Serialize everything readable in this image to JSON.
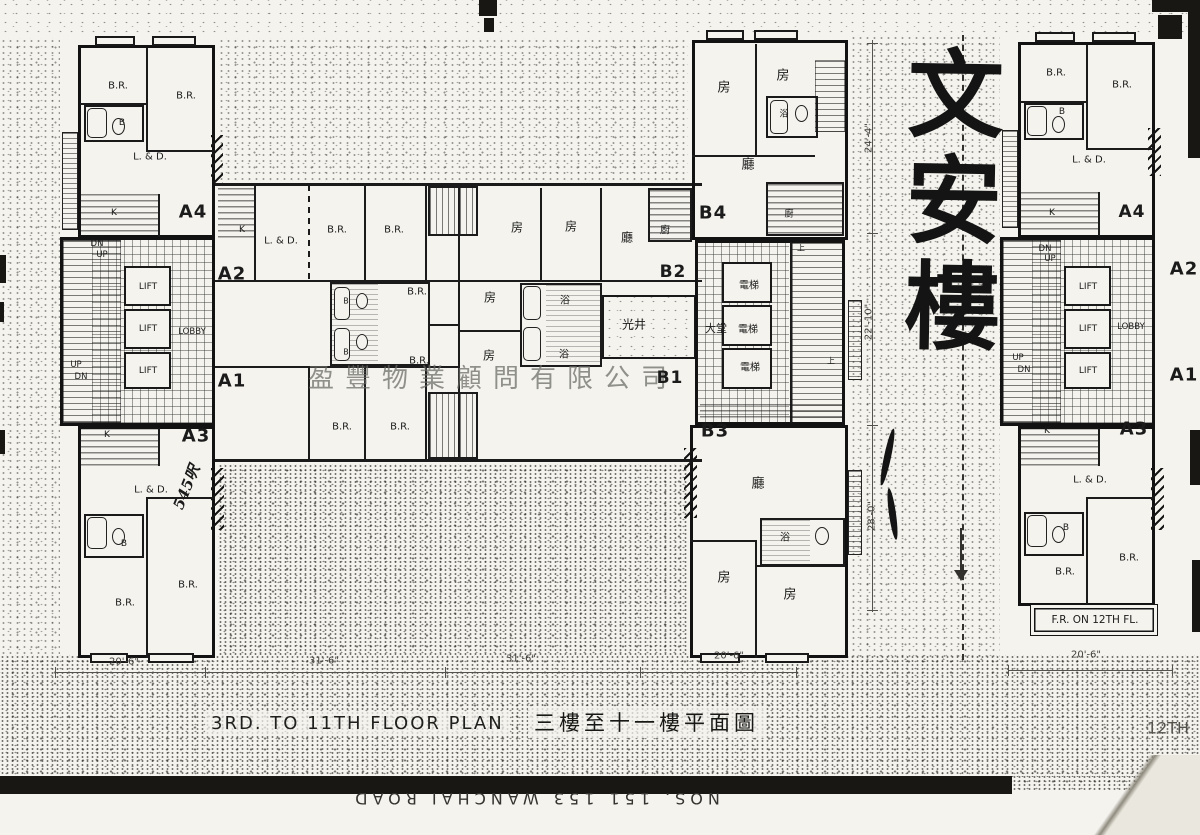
{
  "page": {
    "title_en": "3RD. TO 11TH FLOOR PLAN",
    "title_zh": "三樓至十一樓平面圖",
    "building_name": "文安樓",
    "watermark": "盈豐物業顧問有限公司",
    "street_text": "NOS. 151  153  WANCHAI  ROAD"
  },
  "colors": {
    "ink": "#1b1b1b",
    "paper": "#f4f3ee",
    "watermark": "#69695f"
  },
  "labels": [
    {
      "id": "a4-br1",
      "text": "B.R.",
      "x": 118,
      "y": 86,
      "s": 10
    },
    {
      "id": "a4-br2",
      "text": "B.R.",
      "x": 186,
      "y": 96,
      "s": 10
    },
    {
      "id": "a4-b",
      "text": "B",
      "x": 122,
      "y": 123,
      "s": 9
    },
    {
      "id": "a4-ld",
      "text": "L. & D.",
      "x": 150,
      "y": 157,
      "s": 10
    },
    {
      "id": "a4-k",
      "text": "K",
      "x": 114,
      "y": 213,
      "s": 9
    },
    {
      "id": "unit-a4",
      "text": "A4",
      "x": 193,
      "y": 212,
      "s": 18,
      "b": 1
    },
    {
      "id": "a4-dn",
      "text": "DN",
      "x": 97,
      "y": 244,
      "s": 8.5
    },
    {
      "id": "a4-up",
      "text": "UP",
      "x": 102,
      "y": 255,
      "s": 8.5
    },
    {
      "id": "lift-1",
      "text": "LIFT",
      "x": 148,
      "y": 287,
      "s": 9
    },
    {
      "id": "lift-2",
      "text": "LIFT",
      "x": 148,
      "y": 329,
      "s": 9
    },
    {
      "id": "lift-3",
      "text": "LIFT",
      "x": 148,
      "y": 371,
      "s": 9
    },
    {
      "id": "lobby",
      "text": "LOBBY",
      "x": 192,
      "y": 332,
      "s": 8.5
    },
    {
      "id": "core-up",
      "text": "UP",
      "x": 76,
      "y": 365,
      "s": 8.5
    },
    {
      "id": "core-dn",
      "text": "DN",
      "x": 81,
      "y": 377,
      "s": 8.5
    },
    {
      "id": "unit-a2",
      "text": "A2",
      "x": 232,
      "y": 274,
      "s": 18,
      "b": 1
    },
    {
      "id": "unit-a1",
      "text": "A1",
      "x": 232,
      "y": 381,
      "s": 18,
      "b": 1
    },
    {
      "id": "unit-a3",
      "text": "A3",
      "x": 196,
      "y": 436,
      "s": 18,
      "b": 1
    },
    {
      "id": "a3-k",
      "text": "K",
      "x": 107,
      "y": 435,
      "s": 9
    },
    {
      "id": "a3-ld",
      "text": "L. & D.",
      "x": 151,
      "y": 490,
      "s": 10
    },
    {
      "id": "a3-b",
      "text": "B",
      "x": 124,
      "y": 544,
      "s": 9
    },
    {
      "id": "a3-br1",
      "text": "B.R.",
      "x": 188,
      "y": 585,
      "s": 10
    },
    {
      "id": "a3-br2",
      "text": "B.R.",
      "x": 125,
      "y": 603,
      "s": 10
    },
    {
      "id": "note-545",
      "text": "545呎",
      "x": 186,
      "y": 487,
      "s": 15,
      "rot": -68,
      "cls": "hand"
    },
    {
      "id": "a2-k",
      "text": "K",
      "x": 242,
      "y": 230,
      "s": 9
    },
    {
      "id": "a2-ld",
      "text": "L. & D.",
      "x": 281,
      "y": 241,
      "s": 10
    },
    {
      "id": "a2-br1",
      "text": "B.R.",
      "x": 337,
      "y": 230,
      "s": 10
    },
    {
      "id": "a2-br2",
      "text": "B.R.",
      "x": 394,
      "y": 230,
      "s": 10
    },
    {
      "id": "mid-br1",
      "text": "B.R.",
      "x": 417,
      "y": 292,
      "s": 10
    },
    {
      "id": "mid-b1",
      "text": "B",
      "x": 346,
      "y": 301,
      "s": 8
    },
    {
      "id": "mid-b2",
      "text": "B",
      "x": 346,
      "y": 352,
      "s": 8
    },
    {
      "id": "mid-br2",
      "text": "B.R.",
      "x": 419,
      "y": 361,
      "s": 10
    },
    {
      "id": "a1-br1",
      "text": "B.R.",
      "x": 342,
      "y": 427,
      "s": 10
    },
    {
      "id": "a1-br2",
      "text": "B.R.",
      "x": 400,
      "y": 427,
      "s": 10
    },
    {
      "id": "b2-r1",
      "text": "房",
      "x": 517,
      "y": 227,
      "s": 12,
      "cls": "cjk"
    },
    {
      "id": "b2-r2",
      "text": "房",
      "x": 571,
      "y": 226,
      "s": 12,
      "cls": "cjk"
    },
    {
      "id": "b2-liv",
      "text": "廳",
      "x": 627,
      "y": 237,
      "s": 12,
      "cls": "cjk"
    },
    {
      "id": "b2-kit",
      "text": "廚",
      "x": 665,
      "y": 229,
      "s": 10,
      "cls": "cjk"
    },
    {
      "id": "unit-b2",
      "text": "B2",
      "x": 673,
      "y": 272,
      "s": 17,
      "b": 1
    },
    {
      "id": "b1-r1",
      "text": "房",
      "x": 490,
      "y": 297,
      "s": 12,
      "cls": "cjk"
    },
    {
      "id": "b1-bath1",
      "text": "浴",
      "x": 565,
      "y": 299,
      "s": 10,
      "cls": "cjk"
    },
    {
      "id": "lightwell",
      "text": "光井",
      "x": 634,
      "y": 324,
      "s": 12,
      "cls": "cjk"
    },
    {
      "id": "b1-bath2",
      "text": "浴",
      "x": 564,
      "y": 353,
      "s": 10,
      "cls": "cjk"
    },
    {
      "id": "b1-r2",
      "text": "房",
      "x": 489,
      "y": 355,
      "s": 12,
      "cls": "cjk"
    },
    {
      "id": "unit-b1",
      "text": "B1",
      "x": 670,
      "y": 378,
      "s": 17,
      "b": 1
    },
    {
      "id": "b4-r1",
      "text": "房",
      "x": 724,
      "y": 86,
      "s": 13,
      "cls": "cjk"
    },
    {
      "id": "b4-r2",
      "text": "房",
      "x": 783,
      "y": 74,
      "s": 13,
      "cls": "cjk"
    },
    {
      "id": "b4-bath",
      "text": "浴",
      "x": 784,
      "y": 113,
      "s": 9,
      "cls": "cjk"
    },
    {
      "id": "b4-liv",
      "text": "廳",
      "x": 748,
      "y": 163,
      "s": 13,
      "cls": "cjk"
    },
    {
      "id": "unit-b4",
      "text": "B4",
      "x": 713,
      "y": 213,
      "s": 18,
      "b": 1
    },
    {
      "id": "b4-kit",
      "text": "廚",
      "x": 789,
      "y": 213,
      "s": 9,
      "cls": "cjk"
    },
    {
      "id": "elev-1",
      "text": "電梯",
      "x": 749,
      "y": 284,
      "s": 10,
      "cls": "cjk"
    },
    {
      "id": "elev-2",
      "text": "電梯",
      "x": 748,
      "y": 328,
      "s": 10,
      "cls": "cjk"
    },
    {
      "id": "elev-3",
      "text": "電梯",
      "x": 750,
      "y": 366,
      "s": 10,
      "cls": "cjk"
    },
    {
      "id": "hall",
      "text": "大堂",
      "x": 716,
      "y": 328,
      "s": 11,
      "cls": "cjk"
    },
    {
      "id": "stair-up1",
      "text": "上",
      "x": 801,
      "y": 248,
      "s": 8,
      "cls": "cjk"
    },
    {
      "id": "stair-up2",
      "text": "上",
      "x": 831,
      "y": 361,
      "s": 8,
      "cls": "cjk"
    },
    {
      "id": "unit-b3",
      "text": "B3",
      "x": 715,
      "y": 431,
      "s": 18,
      "b": 1
    },
    {
      "id": "b3-liv",
      "text": "廳",
      "x": 758,
      "y": 482,
      "s": 13,
      "cls": "cjk"
    },
    {
      "id": "b3-bath",
      "text": "浴",
      "x": 785,
      "y": 536,
      "s": 10,
      "cls": "cjk"
    },
    {
      "id": "b3-r1",
      "text": "房",
      "x": 724,
      "y": 576,
      "s": 13,
      "cls": "cjk"
    },
    {
      "id": "b3-r2",
      "text": "房",
      "x": 790,
      "y": 593,
      "s": 13,
      "cls": "cjk"
    },
    {
      "id": "rp-br1",
      "text": "B.R.",
      "x": 1056,
      "y": 73,
      "s": 10
    },
    {
      "id": "rp-br2",
      "text": "B.R.",
      "x": 1122,
      "y": 85,
      "s": 10
    },
    {
      "id": "rp-b1",
      "text": "B",
      "x": 1062,
      "y": 112,
      "s": 9
    },
    {
      "id": "rp-ld1",
      "text": "L. & D.",
      "x": 1089,
      "y": 160,
      "s": 10
    },
    {
      "id": "rp-k1",
      "text": "K",
      "x": 1052,
      "y": 213,
      "s": 9
    },
    {
      "id": "rp-a4",
      "text": "A4",
      "x": 1132,
      "y": 212,
      "s": 17,
      "b": 1
    },
    {
      "id": "rp-dn1",
      "text": "DN",
      "x": 1045,
      "y": 249,
      "s": 8.5
    },
    {
      "id": "rp-up1",
      "text": "UP",
      "x": 1050,
      "y": 259,
      "s": 8.5
    },
    {
      "id": "rp-lift1",
      "text": "LIFT",
      "x": 1088,
      "y": 287,
      "s": 9
    },
    {
      "id": "rp-lift2",
      "text": "LIFT",
      "x": 1088,
      "y": 329,
      "s": 9
    },
    {
      "id": "rp-lift3",
      "text": "LIFT",
      "x": 1088,
      "y": 371,
      "s": 9
    },
    {
      "id": "rp-lobby",
      "text": "LOBBY",
      "x": 1131,
      "y": 327,
      "s": 8.5
    },
    {
      "id": "rp-up2",
      "text": "UP",
      "x": 1018,
      "y": 358,
      "s": 8.5
    },
    {
      "id": "rp-dn2",
      "text": "DN",
      "x": 1024,
      "y": 370,
      "s": 8.5
    },
    {
      "id": "rp-a2",
      "text": "A2",
      "x": 1184,
      "y": 269,
      "s": 18,
      "b": 1
    },
    {
      "id": "rp-a1",
      "text": "A1",
      "x": 1184,
      "y": 375,
      "s": 18,
      "b": 1
    },
    {
      "id": "rp-a3",
      "text": "A3",
      "x": 1134,
      "y": 429,
      "s": 18,
      "b": 1
    },
    {
      "id": "rp-k2",
      "text": "K",
      "x": 1047,
      "y": 431,
      "s": 9
    },
    {
      "id": "rp-ld2",
      "text": "L. & D.",
      "x": 1090,
      "y": 480,
      "s": 10
    },
    {
      "id": "rp-b2",
      "text": "B",
      "x": 1066,
      "y": 528,
      "s": 9
    },
    {
      "id": "rp-br3",
      "text": "B.R.",
      "x": 1129,
      "y": 558,
      "s": 10
    },
    {
      "id": "rp-br4",
      "text": "B.R.",
      "x": 1065,
      "y": 572,
      "s": 10
    },
    {
      "id": "fr-note",
      "text": "F.R. ON 12TH FL.",
      "x": 1095,
      "y": 620,
      "s": 10.5
    },
    {
      "id": "corner-12th",
      "text": "12TH",
      "x": 1168,
      "y": 728,
      "s": 16,
      "cls": "faint"
    },
    {
      "id": "dim-20-6-a",
      "text": "20'-6\"",
      "x": 124,
      "y": 662,
      "s": 10,
      "cls": "dim"
    },
    {
      "id": "dim-31-6-a",
      "text": "31'-6\"",
      "x": 324,
      "y": 661,
      "s": 10,
      "cls": "dim"
    },
    {
      "id": "dim-31-6-b",
      "text": "31'-6\"",
      "x": 521,
      "y": 659,
      "s": 10,
      "cls": "dim"
    },
    {
      "id": "dim-20-6-b",
      "text": "20'-6\"",
      "x": 729,
      "y": 656,
      "s": 10,
      "cls": "dim"
    },
    {
      "id": "dim-20-6-c",
      "text": "20'-6\"",
      "x": 1086,
      "y": 655,
      "s": 10,
      "cls": "dim"
    },
    {
      "id": "dim-24-4",
      "text": "24'-4\"",
      "x": 869,
      "y": 138,
      "s": 10,
      "rot": -90,
      "cls": "dim"
    },
    {
      "id": "dim-22-10",
      "text": "22'-10\"",
      "x": 869,
      "y": 322,
      "s": 10,
      "rot": -90,
      "cls": "dim"
    },
    {
      "id": "dim-28-0",
      "text": "28'-0\"",
      "x": 872,
      "y": 516,
      "s": 10,
      "rot": -90,
      "cls": "dim"
    }
  ]
}
